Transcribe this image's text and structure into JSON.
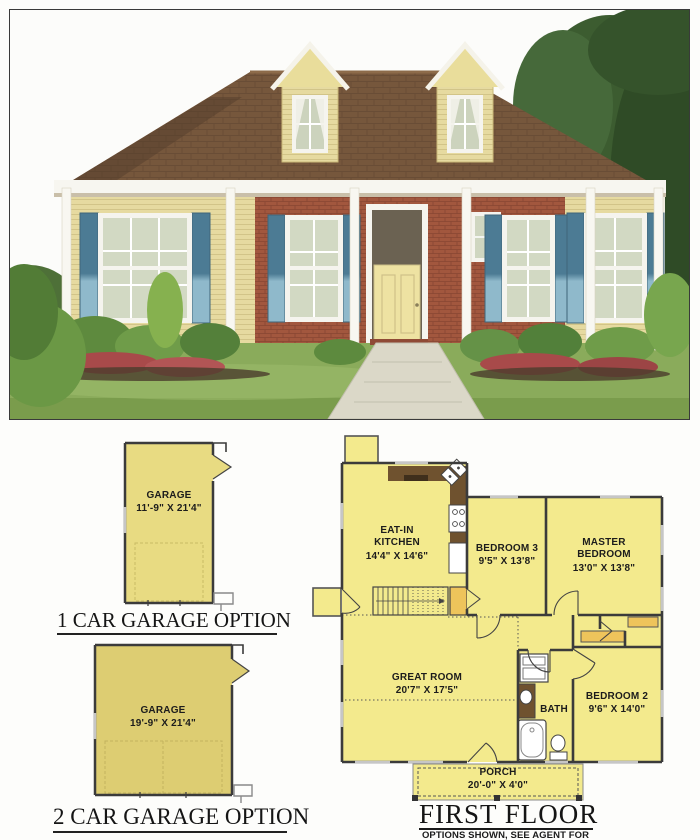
{
  "garage_options": [
    {
      "room": "GARAGE",
      "dims": "11'-9\" X 21'4\"",
      "caption": "1 CAR GARAGE OPTION"
    },
    {
      "room": "GARAGE",
      "dims": "19'-9\" X 21'4\"",
      "caption": "2 CAR GARAGE OPTION"
    }
  ],
  "floorplan": {
    "rooms": [
      {
        "name": "EAT-IN\nKITCHEN",
        "dims": "14'4\" X 14'6\""
      },
      {
        "name": "BEDROOM 3",
        "dims": "9'5\" X 13'8\""
      },
      {
        "name": "MASTER\nBEDROOM",
        "dims": "13'0\" X 13'8\""
      },
      {
        "name": "GREAT ROOM",
        "dims": "20'7\" X 17'5\""
      },
      {
        "name": "BATH",
        "dims": ""
      },
      {
        "name": "BEDROOM 2",
        "dims": "9'6\" X 14'0\""
      },
      {
        "name": "PORCH",
        "dims": "20'-0\" X 4'0\""
      }
    ]
  },
  "title": {
    "main": "FIRST FLOOR",
    "subtitle": "OPTIONS SHOWN, SEE AGENT FOR DETAILS"
  },
  "colors": {
    "plan_fill": "#f3ea8d",
    "garage1_fill": "#e8db82",
    "garage2_fill": "#ddcd72",
    "closet_shelf": "#eec45b",
    "counter_brown": "#6f522f",
    "wall": "#3b3b3b",
    "window_gap": "#c6c6c6",
    "roof": "#76573c",
    "siding": "#e6daa0",
    "brick": "#a2573e",
    "shutters": "#4c7b94",
    "front_door": "#eee2a2",
    "lawn": "#8aab5b",
    "walkway": "#dbd8c8"
  }
}
